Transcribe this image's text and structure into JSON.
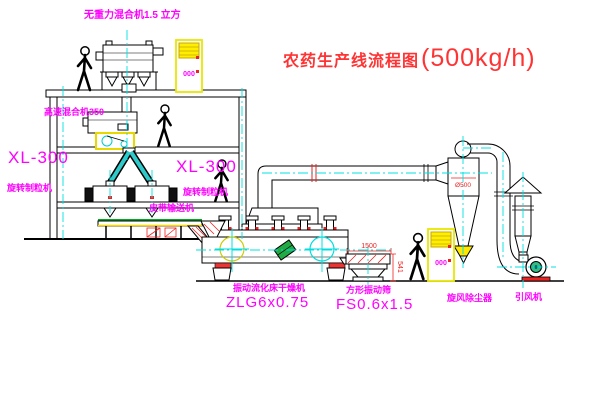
{
  "title": {
    "cn": "农药生产线流程图",
    "capacity": "(500kg/h)"
  },
  "labels": {
    "gravity_free_mixer": "无重力混合机1.5 立方",
    "high_speed_mixer": "高速混合机350",
    "granulator_left_model": "XL-300",
    "granulator_left_name": "旋转制粒机",
    "granulator_mid_model": "XL-300",
    "granulator_mid_name": "旋转制粒机",
    "belt_conveyor": "皮带输送机",
    "fluid_bed_dryer_name": "振动流化床干燥机",
    "fluid_bed_dryer_model": "ZLG6x0.75",
    "square_sieve_name": "方形振动筛",
    "square_sieve_model": "FS0.6x1.5",
    "cyclone_name": "旋风除尘器",
    "induced_fan_name": "引风机"
  },
  "dims": {
    "sieve_length": "1500",
    "sieve_height": "541",
    "cyclone_diameter": "Ø500"
  },
  "cabinets": [
    {
      "indicator": "000"
    },
    {
      "indicator": "000"
    }
  ],
  "colors": {
    "label_magenta": "#FF00FF",
    "title_red": "#FF3333",
    "centerline_cyan": "#00E0E0",
    "highlight_yellow": "#FFEE00",
    "machine_green": "#22AA44",
    "alert_red": "#EE2222"
  }
}
